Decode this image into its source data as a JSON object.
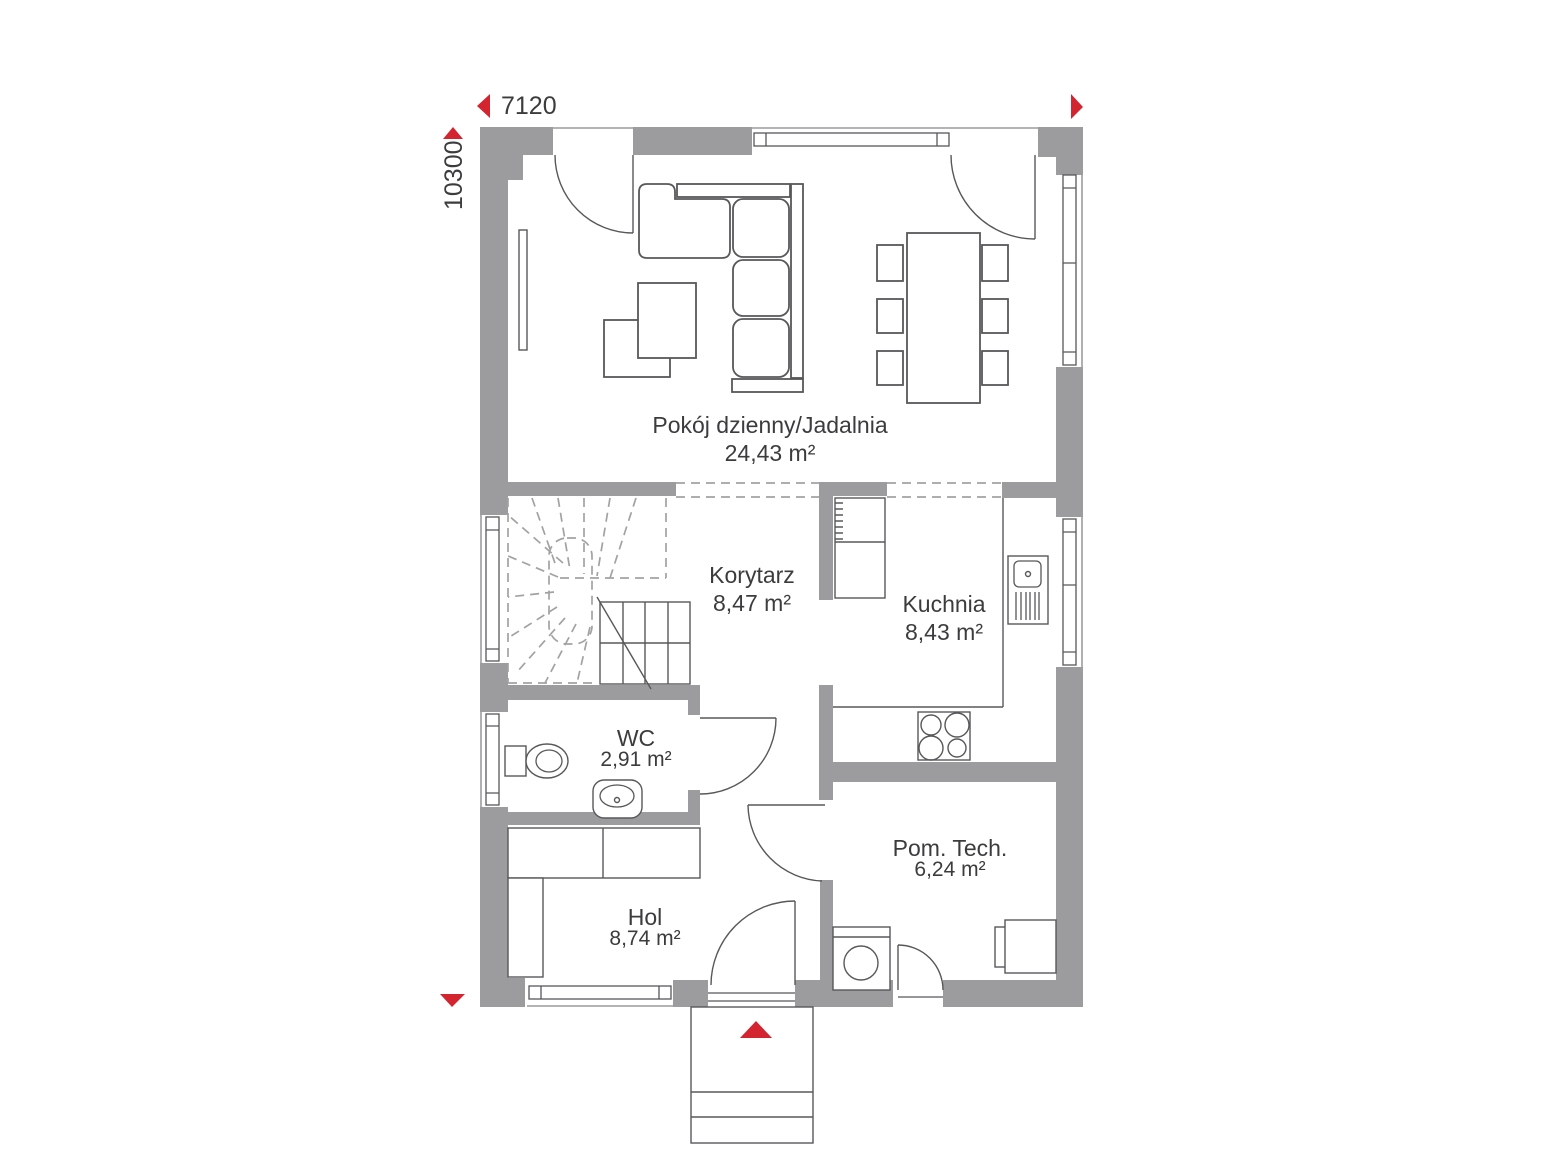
{
  "plan": {
    "dimension_width": "7120",
    "dimension_height": "10300",
    "rooms": {
      "living": {
        "name": "Pokój dzienny/Jadalnia",
        "area": "24,43 m²"
      },
      "corridor": {
        "name": "Korytarz",
        "area": "8,47 m²"
      },
      "kitchen": {
        "name": "Kuchnia",
        "area": "8,43 m²"
      },
      "wc": {
        "name": "WC",
        "area": "2,91 m²"
      },
      "hall": {
        "name": "Hol",
        "area": "8,74 m²"
      },
      "tech": {
        "name": "Pom. Tech.",
        "area": "6,24 m²"
      }
    },
    "colors": {
      "wall": "#9c9c9f",
      "line": "#58585a",
      "text": "#3c3c3e",
      "red": "#d2252f",
      "dashc": "#a2a2a4"
    }
  }
}
